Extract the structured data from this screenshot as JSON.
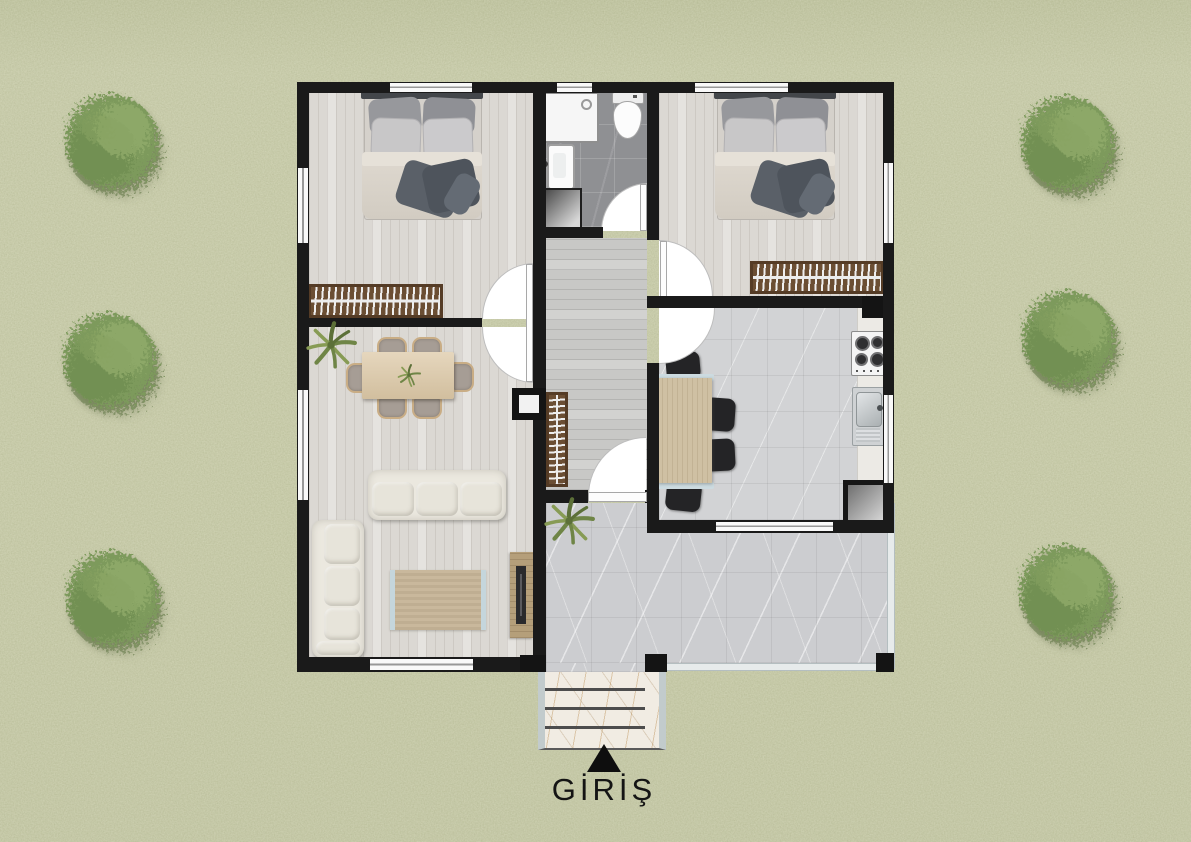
{
  "scene": {
    "description": "top-down architectural floor plan of a single-storey house on a grass lot with round trees"
  },
  "entrance": {
    "label": "GİRİŞ",
    "marker": "up-triangle"
  },
  "site": {
    "tree_count": 6,
    "colors": {
      "grass": "#c6caa6",
      "tree": "#7d9a5b"
    }
  },
  "plan": {
    "colors": {
      "wall": "#1a1a1a",
      "wood_floor": "#dbd8d3",
      "hall_floor": "#c8c8c6",
      "bath_floor": "#8f9093",
      "kitchen_tile": "#d2d3d5",
      "terrace_tile": "#cccdd0",
      "radiator": "#6b4e33",
      "sofa": "#ebe8df",
      "table_wood": "#ddc9a7",
      "door_swing": "#ffffff",
      "railing": "#e7ebeb",
      "stairs_marble": "#f1ece3"
    },
    "rooms": [
      {
        "name": "bedroom-1",
        "furniture": [
          "double-bed",
          "radiator"
        ]
      },
      {
        "name": "bathroom",
        "furniture": [
          "shower",
          "toilet",
          "washbasin",
          "washing-machine"
        ]
      },
      {
        "name": "bedroom-2",
        "furniture": [
          "double-bed",
          "radiator"
        ]
      },
      {
        "name": "hallway",
        "furniture": [
          "radiator"
        ]
      },
      {
        "name": "kitchen",
        "furniture": [
          "dining-table",
          "chairs",
          "cooktop",
          "sink",
          "counter",
          "cabinet"
        ]
      },
      {
        "name": "living-room",
        "furniture": [
          "dining-table",
          "chairs",
          "sofa",
          "corner-sofa",
          "rug",
          "tv-unit",
          "potted-plant"
        ]
      },
      {
        "name": "terrace",
        "furniture": [
          "potted-plant",
          "glass-railing"
        ]
      },
      {
        "name": "entry-stairs",
        "furniture": []
      }
    ],
    "door_count": 6,
    "window_count": 9
  }
}
